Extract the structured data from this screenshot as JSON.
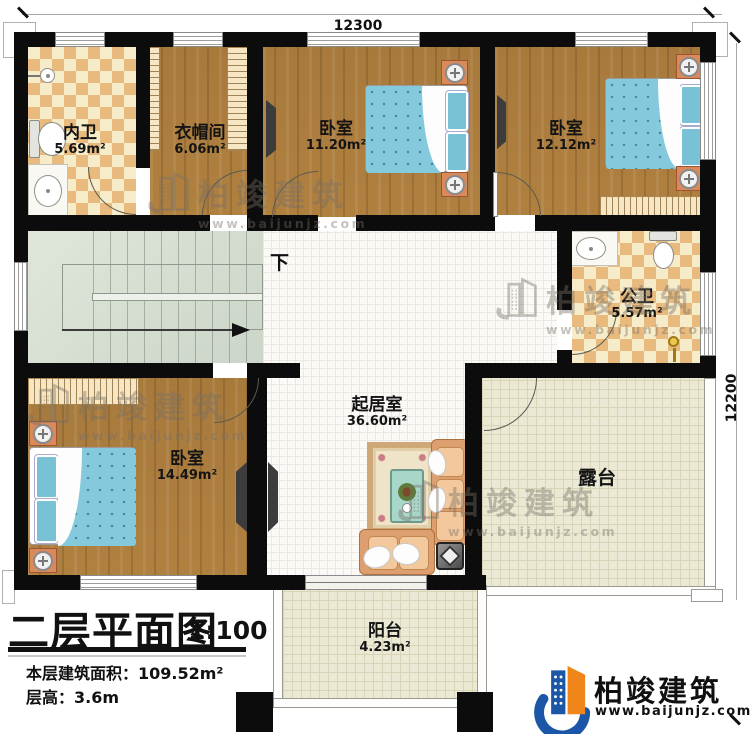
{
  "plan": {
    "dim_top": "12300",
    "dim_right": "12200",
    "down_label": "下",
    "rooms": {
      "neiwei": {
        "name": "内卫",
        "area": "5.69m²"
      },
      "cloak": {
        "name": "衣帽间",
        "area": "6.06m²"
      },
      "bed_top": {
        "name": "卧室",
        "area": "11.20m²"
      },
      "bed_right": {
        "name": "卧室",
        "area": "12.12m²"
      },
      "gongwei": {
        "name": "公卫",
        "area": "5.57m²"
      },
      "bed_bottom": {
        "name": "卧室",
        "area": "14.49m²"
      },
      "living": {
        "name": "起居室",
        "area": "36.60m²"
      },
      "terrace": {
        "name": "露台"
      },
      "balcony": {
        "name": "阳台",
        "area": "4.23m²"
      }
    }
  },
  "title_block": {
    "title": "二层平面图",
    "scale": "1:100",
    "area_label": "本层建筑面积：",
    "area_value": "109.52m²",
    "height_label": "层高：",
    "height_value": "3.6m"
  },
  "brand": {
    "name": "柏竣建筑",
    "url": "www.baijunjz.com",
    "blue": "#1b57a6",
    "orange": "#f08519"
  },
  "watermark": {
    "name": "柏竣建筑",
    "url": "www.baijunjz.com"
  }
}
